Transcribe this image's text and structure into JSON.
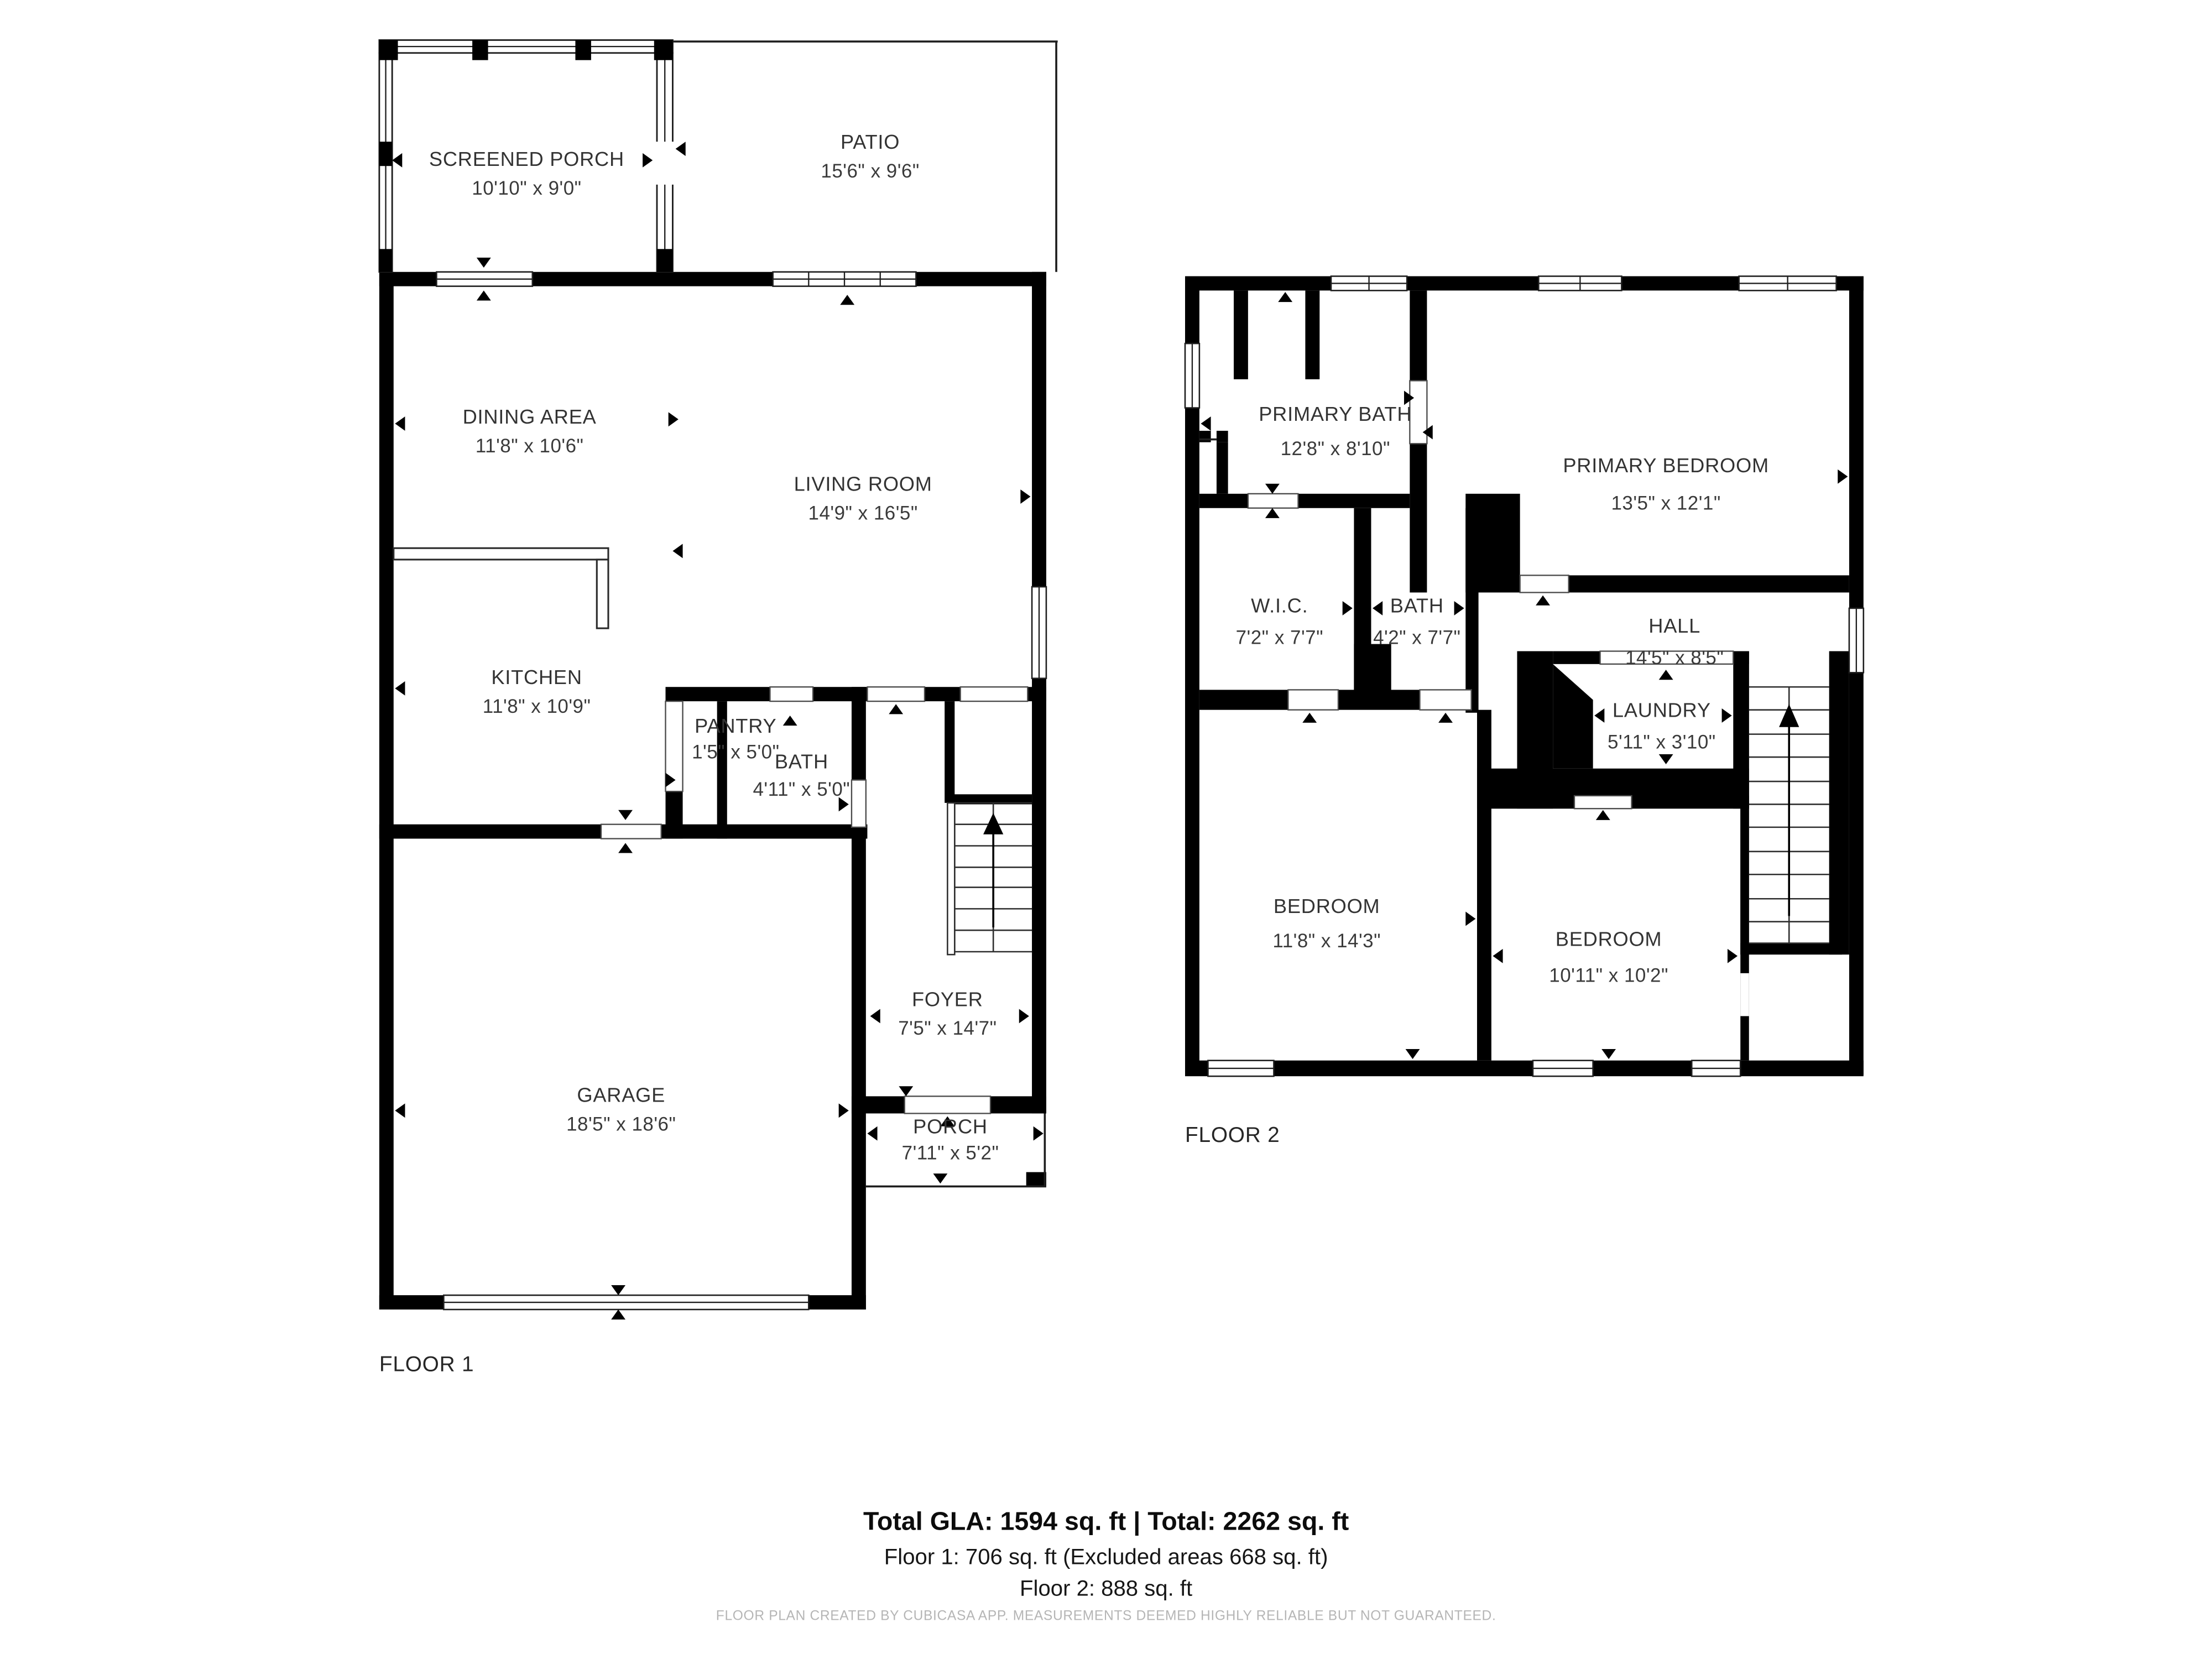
{
  "floor1": {
    "label": "FLOOR 1",
    "rooms": [
      {
        "id": "screened-porch",
        "name": "SCREENED PORCH",
        "dims": "10'10\" x 9'0\""
      },
      {
        "id": "patio",
        "name": "PATIO",
        "dims": "15'6\" x 9'6\""
      },
      {
        "id": "dining-area",
        "name": "DINING AREA",
        "dims": "11'8\" x 10'6\""
      },
      {
        "id": "living-room",
        "name": "LIVING ROOM",
        "dims": "14'9\" x 16'5\""
      },
      {
        "id": "kitchen",
        "name": "KITCHEN",
        "dims": "11'8\" x 10'9\""
      },
      {
        "id": "pantry",
        "name": "PANTRY",
        "dims": "1'5\" x 5'0\""
      },
      {
        "id": "bath",
        "name": "BATH",
        "dims": "4'11\" x 5'0\""
      },
      {
        "id": "garage",
        "name": "GARAGE",
        "dims": "18'5\" x 18'6\""
      },
      {
        "id": "foyer",
        "name": "FOYER",
        "dims": "7'5\" x 14'7\""
      },
      {
        "id": "porch",
        "name": "PORCH",
        "dims": "7'11\" x 5'2\""
      }
    ]
  },
  "floor2": {
    "label": "FLOOR 2",
    "rooms": [
      {
        "id": "primary-bath",
        "name": "PRIMARY BATH",
        "dims": "12'8\" x 8'10\""
      },
      {
        "id": "primary-bedroom",
        "name": "PRIMARY BEDROOM",
        "dims": "13'5\" x 12'1\""
      },
      {
        "id": "wic",
        "name": "W.I.C.",
        "dims": "7'2\" x 7'7\""
      },
      {
        "id": "bath",
        "name": "BATH",
        "dims": "4'2\" x 7'7\""
      },
      {
        "id": "hall",
        "name": "HALL",
        "dims": "14'5\" x 8'5\""
      },
      {
        "id": "laundry",
        "name": "LAUNDRY",
        "dims": "5'11\" x 3'10\""
      },
      {
        "id": "bedroom-left",
        "name": "BEDROOM",
        "dims": "11'8\" x 14'3\""
      },
      {
        "id": "bedroom-right",
        "name": "BEDROOM",
        "dims": "10'11\" x 10'2\""
      }
    ]
  },
  "summary": {
    "total_line": "Total GLA: 1594 sq. ft | Total: 2262 sq. ft",
    "floor1_line": "Floor 1: 706 sq. ft (Excluded areas 668 sq. ft)",
    "floor2_line": "Floor 2: 888 sq. ft"
  },
  "disclaimer": "FLOOR PLAN CREATED BY CUBICASA APP. MEASUREMENTS DEEMED HIGHLY RELIABLE BUT NOT GUARANTEED.",
  "colors": {
    "wall": "#000000",
    "label_text": "#333333",
    "summary_text": "#111111",
    "disclaimer_text": "#b5b5b5",
    "background": "#ffffff"
  }
}
